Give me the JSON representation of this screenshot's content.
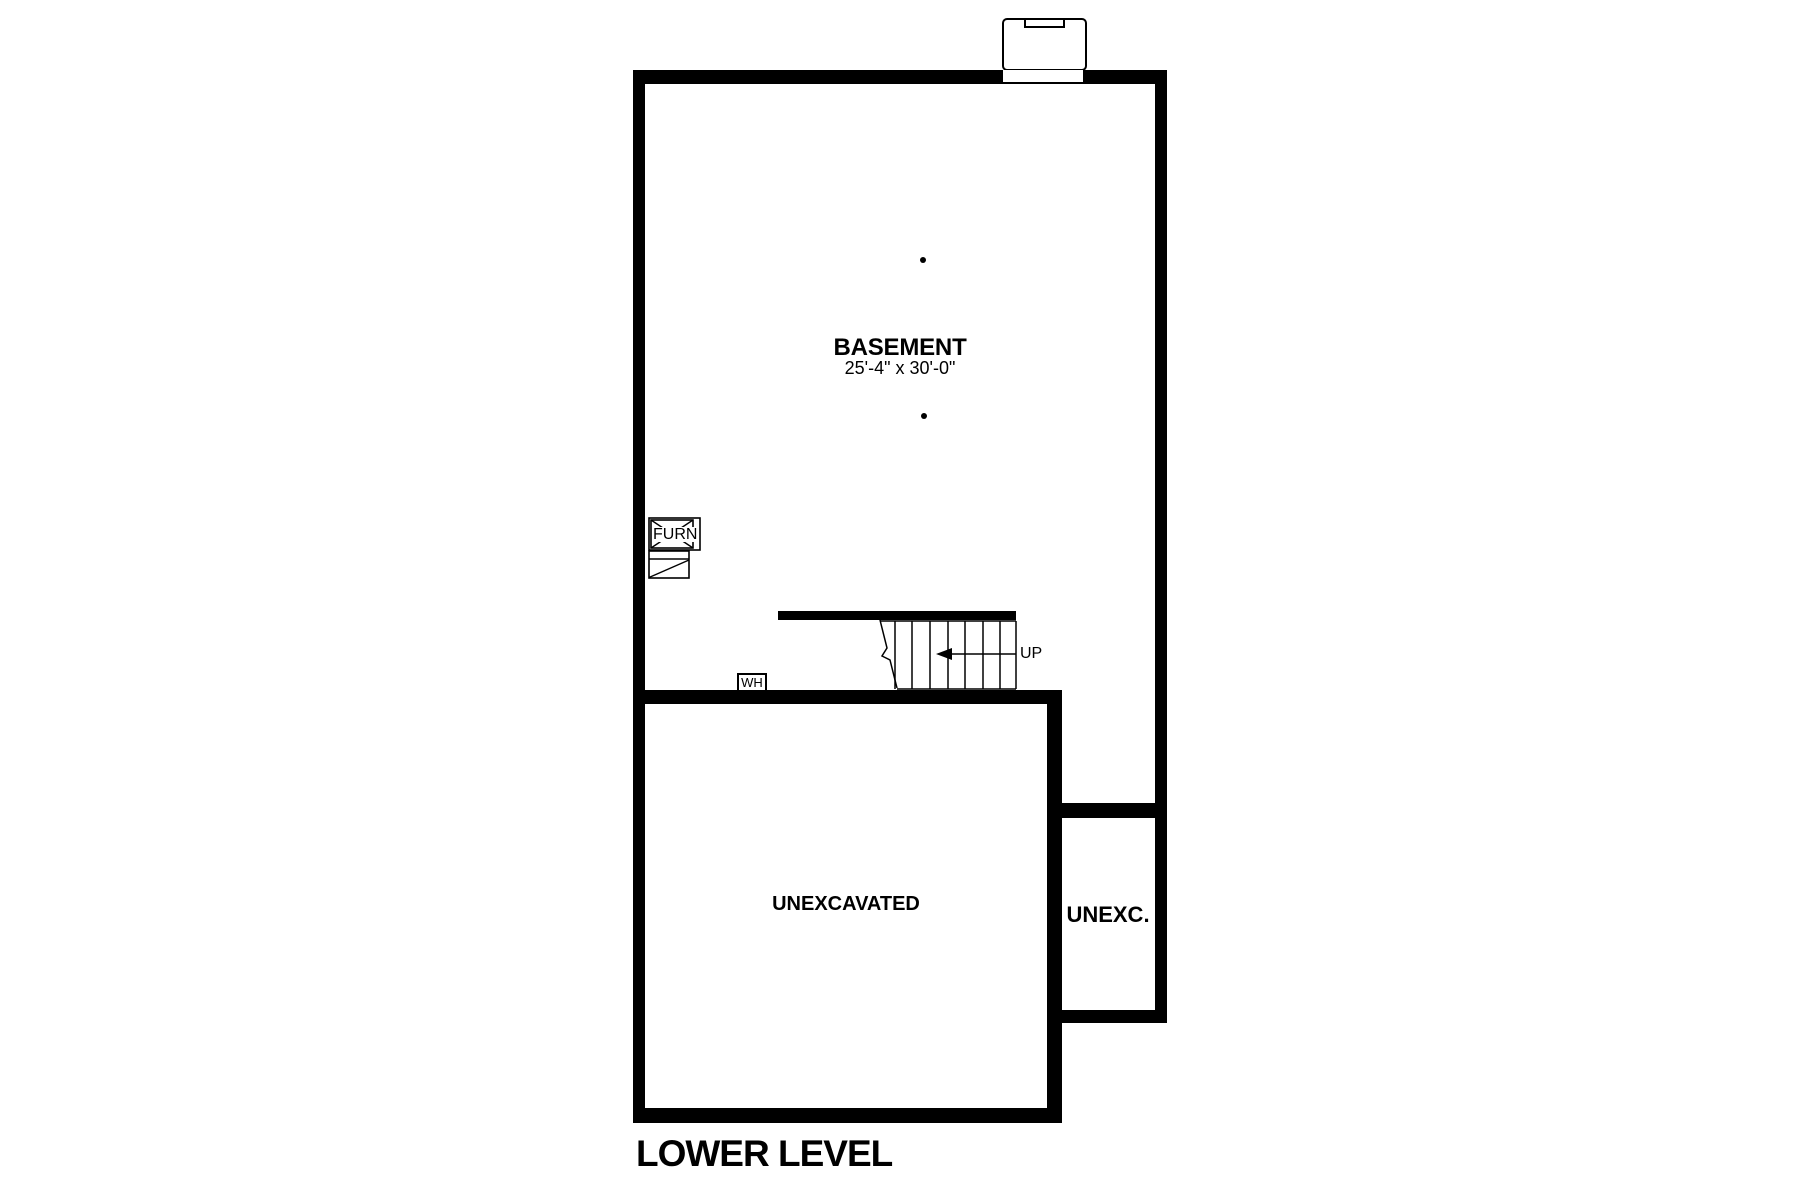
{
  "sheet": {
    "title": "LOWER LEVEL"
  },
  "rooms": {
    "basement": {
      "label": "BASEMENT",
      "dimensions": "25'-4\" x 30'-0\""
    },
    "unexcavated_main": {
      "label": "UNEXCAVATED"
    },
    "unexcavated_side": {
      "label": "UNEXC."
    }
  },
  "fixtures": {
    "furnace": {
      "label": "FURN"
    },
    "water_heater": {
      "label": "WH"
    }
  },
  "stairs": {
    "direction": "UP"
  },
  "colors": {
    "ink": "#000000",
    "paper": "#ffffff"
  }
}
